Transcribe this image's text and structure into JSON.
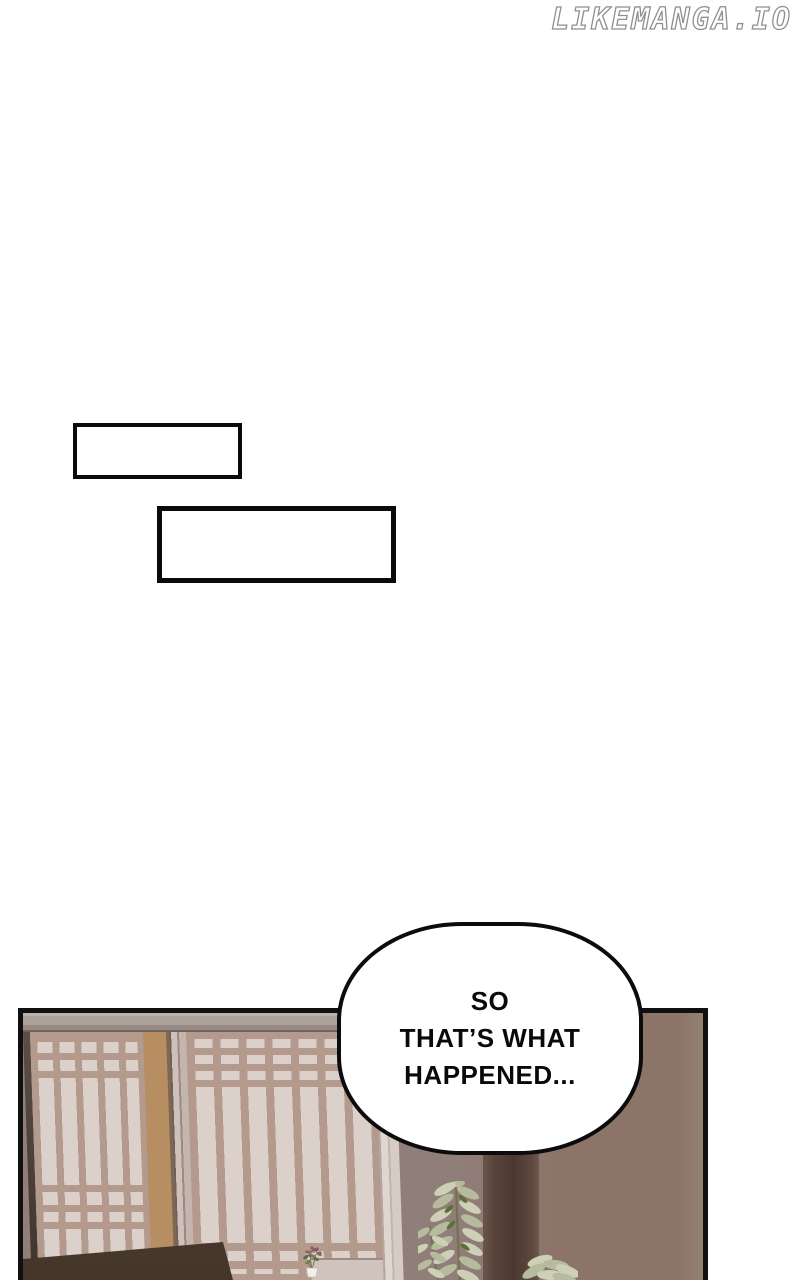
{
  "watermark": {
    "text": "LIKEMANGA.IO"
  },
  "empty_boxes": [
    {
      "text": ""
    },
    {
      "text": ""
    }
  ],
  "speech_bubble": {
    "lines": [
      "SO",
      "THAT’S WHAT",
      "HAPPENED..."
    ]
  },
  "colors": {
    "ink": "#0a0a0a",
    "wm_outline": "#8f8f8f",
    "panel_border": "#101010",
    "bubble_border": "#0c0c0c",
    "paper": "#dcd1ca",
    "slat": "#b49a8d",
    "tan_strip": "#b68e62",
    "frame_strip": "#e0d6d0",
    "sill": "#cfc3bb",
    "wall_cool": "#907e79",
    "wall_warm": "#8c7468",
    "dark_band": "#4a3830",
    "sofa": "#4c3d33",
    "leaf_cream": "#cdcfb6",
    "leaf_light": "#b7bb9e",
    "leaf_dark": "#5e7038",
    "stem": "#75714f",
    "flower": "#9c4f7d",
    "pot": "#f2efec"
  }
}
